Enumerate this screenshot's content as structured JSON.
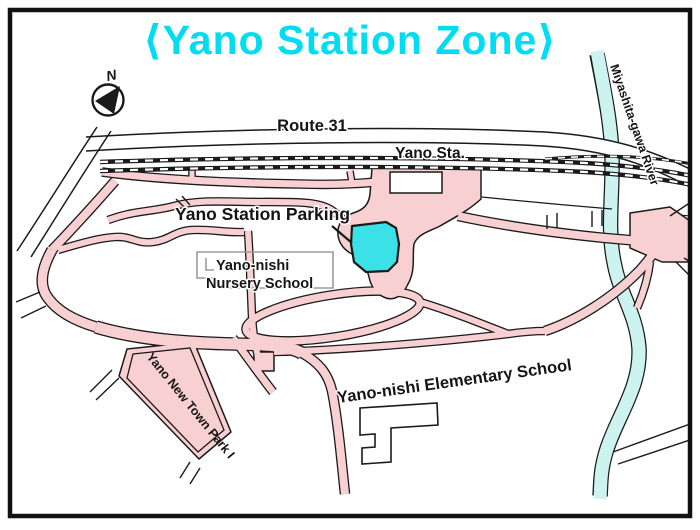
{
  "title": {
    "text": "⟨Yano Station Zone⟩",
    "color": "#00dcf2"
  },
  "compass": {
    "label": "N"
  },
  "labels": {
    "route": "Route 31",
    "station": "Yano Sta.",
    "parking": "Yano Station Parking",
    "nursery_line1": "Yano-nishi",
    "nursery_line2": "Nursery School",
    "park": "Yano New Town Park I",
    "elementary": "Yano-nishi Elementary School",
    "river": "Miyashita-gawa River"
  },
  "colors": {
    "road_fill": "#f8d0d2",
    "river_fill": "#ccf3f0",
    "parking_fill": "#3ae2e8",
    "outline": "#1a1a1a",
    "building_gray": "#9b9b9b"
  }
}
